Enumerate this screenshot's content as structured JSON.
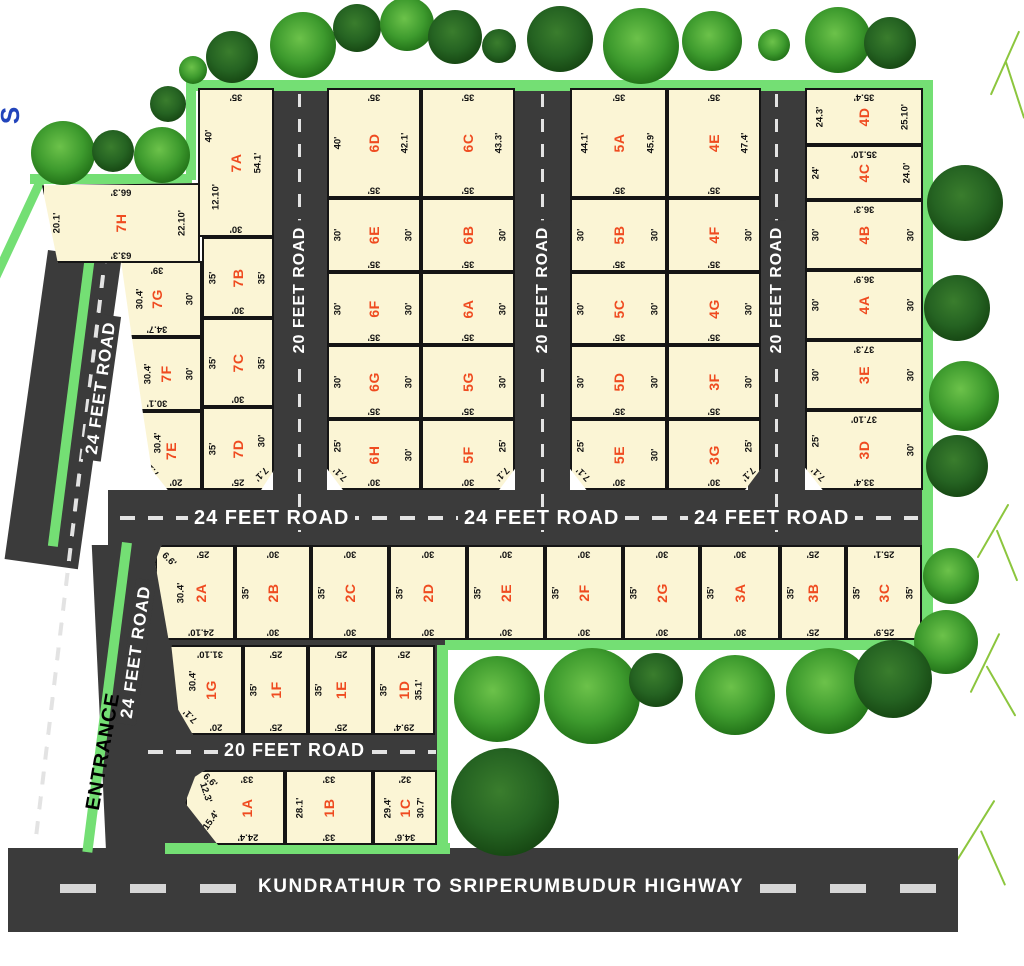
{
  "compass": {
    "label": "S"
  },
  "entrance": {
    "label": "ENTRANCE"
  },
  "roads": {
    "left_upper": "24 FEET ROAD",
    "left_lower": "24 FEET ROAD",
    "vertical": [
      "20 FEET ROAD",
      "20 FEET ROAD",
      "20 FEET ROAD"
    ],
    "middle": [
      "24 FEET ROAD",
      "24 FEET ROAD",
      "24 FEET ROAD"
    ],
    "h20": "20 FEET ROAD",
    "highway": "KUNDRATHUR TO SRIPERUMBUDUR HIGHWAY"
  },
  "colors": {
    "plot_fill": "#fbf5d5",
    "plot_label": "#ef4b20",
    "road": "#3b3b3b",
    "boundary": "#74df74"
  },
  "plots": {
    "7A": {
      "label": "7A",
      "t": "35'",
      "l": "40'",
      "l2": "12.10'",
      "r": "54.1'",
      "b": "30'"
    },
    "7B": {
      "label": "7B",
      "l": "35'",
      "r": "35'",
      "b": "30'"
    },
    "7C": {
      "label": "7C",
      "l": "35'",
      "r": "35'",
      "b": "30'"
    },
    "7D": {
      "label": "7D",
      "l": "35'",
      "r": "30'",
      "b": "25'",
      "c": "7.1'"
    },
    "7E": {
      "label": "7E",
      "l": "30.4'",
      "b": "20'",
      "c": "7.1'"
    },
    "7F": {
      "label": "7F",
      "l": "30.4'",
      "r": "30'",
      "b": "30.1'"
    },
    "7G": {
      "label": "7G",
      "t": "39'",
      "l": "30.4'",
      "r": "30'",
      "b": "34.7'"
    },
    "7H": {
      "label": "7H",
      "t": "66.3'",
      "l": "20.1'",
      "r": "22.10'",
      "b": "63.3'"
    },
    "6A": {
      "label": "6A",
      "r": "30'",
      "b": "35'"
    },
    "6B": {
      "label": "6B",
      "r": "30'",
      "b": "35'"
    },
    "6C": {
      "label": "6C",
      "t": "35'",
      "r": "43.3'",
      "b": "35'"
    },
    "6D": {
      "label": "6D",
      "t": "35'",
      "l": "40'",
      "r": "42.1'",
      "b": "35'"
    },
    "6E": {
      "label": "6E",
      "l": "30'",
      "r": "30'",
      "b": "35'"
    },
    "6F": {
      "label": "6F",
      "l": "30'",
      "r": "30'",
      "b": "35'"
    },
    "6G": {
      "label": "6G",
      "l": "30'",
      "r": "30'",
      "b": "35'"
    },
    "6H": {
      "label": "6H",
      "l": "25'",
      "r": "30'",
      "b": "30'",
      "c": "7.1'"
    },
    "5A": {
      "label": "5A",
      "t": "35'",
      "l": "44.1'",
      "r": "45.9'",
      "b": "35'"
    },
    "5B": {
      "label": "5B",
      "l": "30'",
      "r": "30'",
      "b": "35'"
    },
    "5C": {
      "label": "5C",
      "l": "30'",
      "r": "30'",
      "b": "35'"
    },
    "5D": {
      "label": "5D",
      "l": "30'",
      "r": "30'",
      "b": "35'"
    },
    "5E": {
      "label": "5E",
      "l": "25'",
      "r": "30'",
      "b": "30'",
      "c": "7.1'"
    },
    "5F": {
      "label": "5F",
      "r": "25'",
      "b": "30'",
      "c": "7.1'"
    },
    "5G": {
      "label": "5G",
      "r": "30'",
      "b": "35'"
    },
    "4A": {
      "label": "4A",
      "t": "36.9'",
      "l": "30'",
      "r": "30'"
    },
    "4B": {
      "label": "4B",
      "t": "36.3'",
      "l": "30'",
      "r": "30'"
    },
    "4C": {
      "label": "4C",
      "t": "35.10'",
      "l": "24'",
      "r": "24.0'"
    },
    "4D": {
      "label": "4D",
      "t": "35.4'",
      "l": "24.3'",
      "r": "25.10'"
    },
    "4E": {
      "label": "4E",
      "t": "35'",
      "r": "47.4'",
      "b": "35'"
    },
    "4F": {
      "label": "4F",
      "r": "30'",
      "b": "35'"
    },
    "4G": {
      "label": "4G",
      "r": "30'",
      "b": "35'"
    },
    "3A": {
      "label": "3A",
      "t": "30'",
      "l": "35'",
      "b": "30'"
    },
    "3B": {
      "label": "3B",
      "t": "25'",
      "l": "35'",
      "b": "25'"
    },
    "3C": {
      "label": "3C",
      "t": "25.1'",
      "l": "35'",
      "r": "35'",
      "b": "25.9'"
    },
    "3D": {
      "label": "3D",
      "t": "37.10'",
      "l": "25'",
      "r": "30'",
      "b": "33.4'",
      "c": "7.1'"
    },
    "3E": {
      "label": "3E",
      "t": "37.3'",
      "l": "30'",
      "r": "30'"
    },
    "3F": {
      "label": "3F",
      "r": "30'",
      "b": "35'"
    },
    "3G": {
      "label": "3G",
      "r": "25'",
      "b": "30'",
      "c": "7.1'"
    },
    "2A": {
      "label": "2A",
      "t": "25'",
      "l": "30.4'",
      "b": "24.10'",
      "c": "6.6'"
    },
    "2B": {
      "label": "2B",
      "t": "30'",
      "l": "35'",
      "b": "30'"
    },
    "2C": {
      "label": "2C",
      "t": "30'",
      "l": "35'",
      "b": "30'"
    },
    "2D": {
      "label": "2D",
      "t": "30'",
      "l": "35'",
      "b": "30'"
    },
    "2E": {
      "label": "2E",
      "t": "30'",
      "l": "35'",
      "b": "30'"
    },
    "2F": {
      "label": "2F",
      "t": "30'",
      "l": "35'",
      "b": "30'"
    },
    "2G": {
      "label": "2G",
      "t": "30'",
      "l": "35'",
      "b": "30'"
    },
    "1A": {
      "label": "1A",
      "t": "33'",
      "l": "12.3'",
      "l2": "15.4'",
      "b": "24.4'",
      "c": "6.6'"
    },
    "1B": {
      "label": "1B",
      "t": "33'",
      "l": "28.1'",
      "b": "33'"
    },
    "1C": {
      "label": "1C",
      "t": "32'",
      "l": "29.4'",
      "r": "30.7'",
      "b": "34.6'"
    },
    "1D": {
      "label": "1D",
      "t": "25'",
      "l": "35'",
      "r": "35.1'",
      "b": "29.4'"
    },
    "1E": {
      "label": "1E",
      "t": "25'",
      "l": "35'",
      "b": "25'"
    },
    "1F": {
      "label": "1F",
      "t": "25'",
      "l": "35'",
      "b": "25'"
    },
    "1G": {
      "label": "1G",
      "t": "31.10'",
      "l": "30.4'",
      "b": "20'",
      "c": "7.1'"
    }
  }
}
